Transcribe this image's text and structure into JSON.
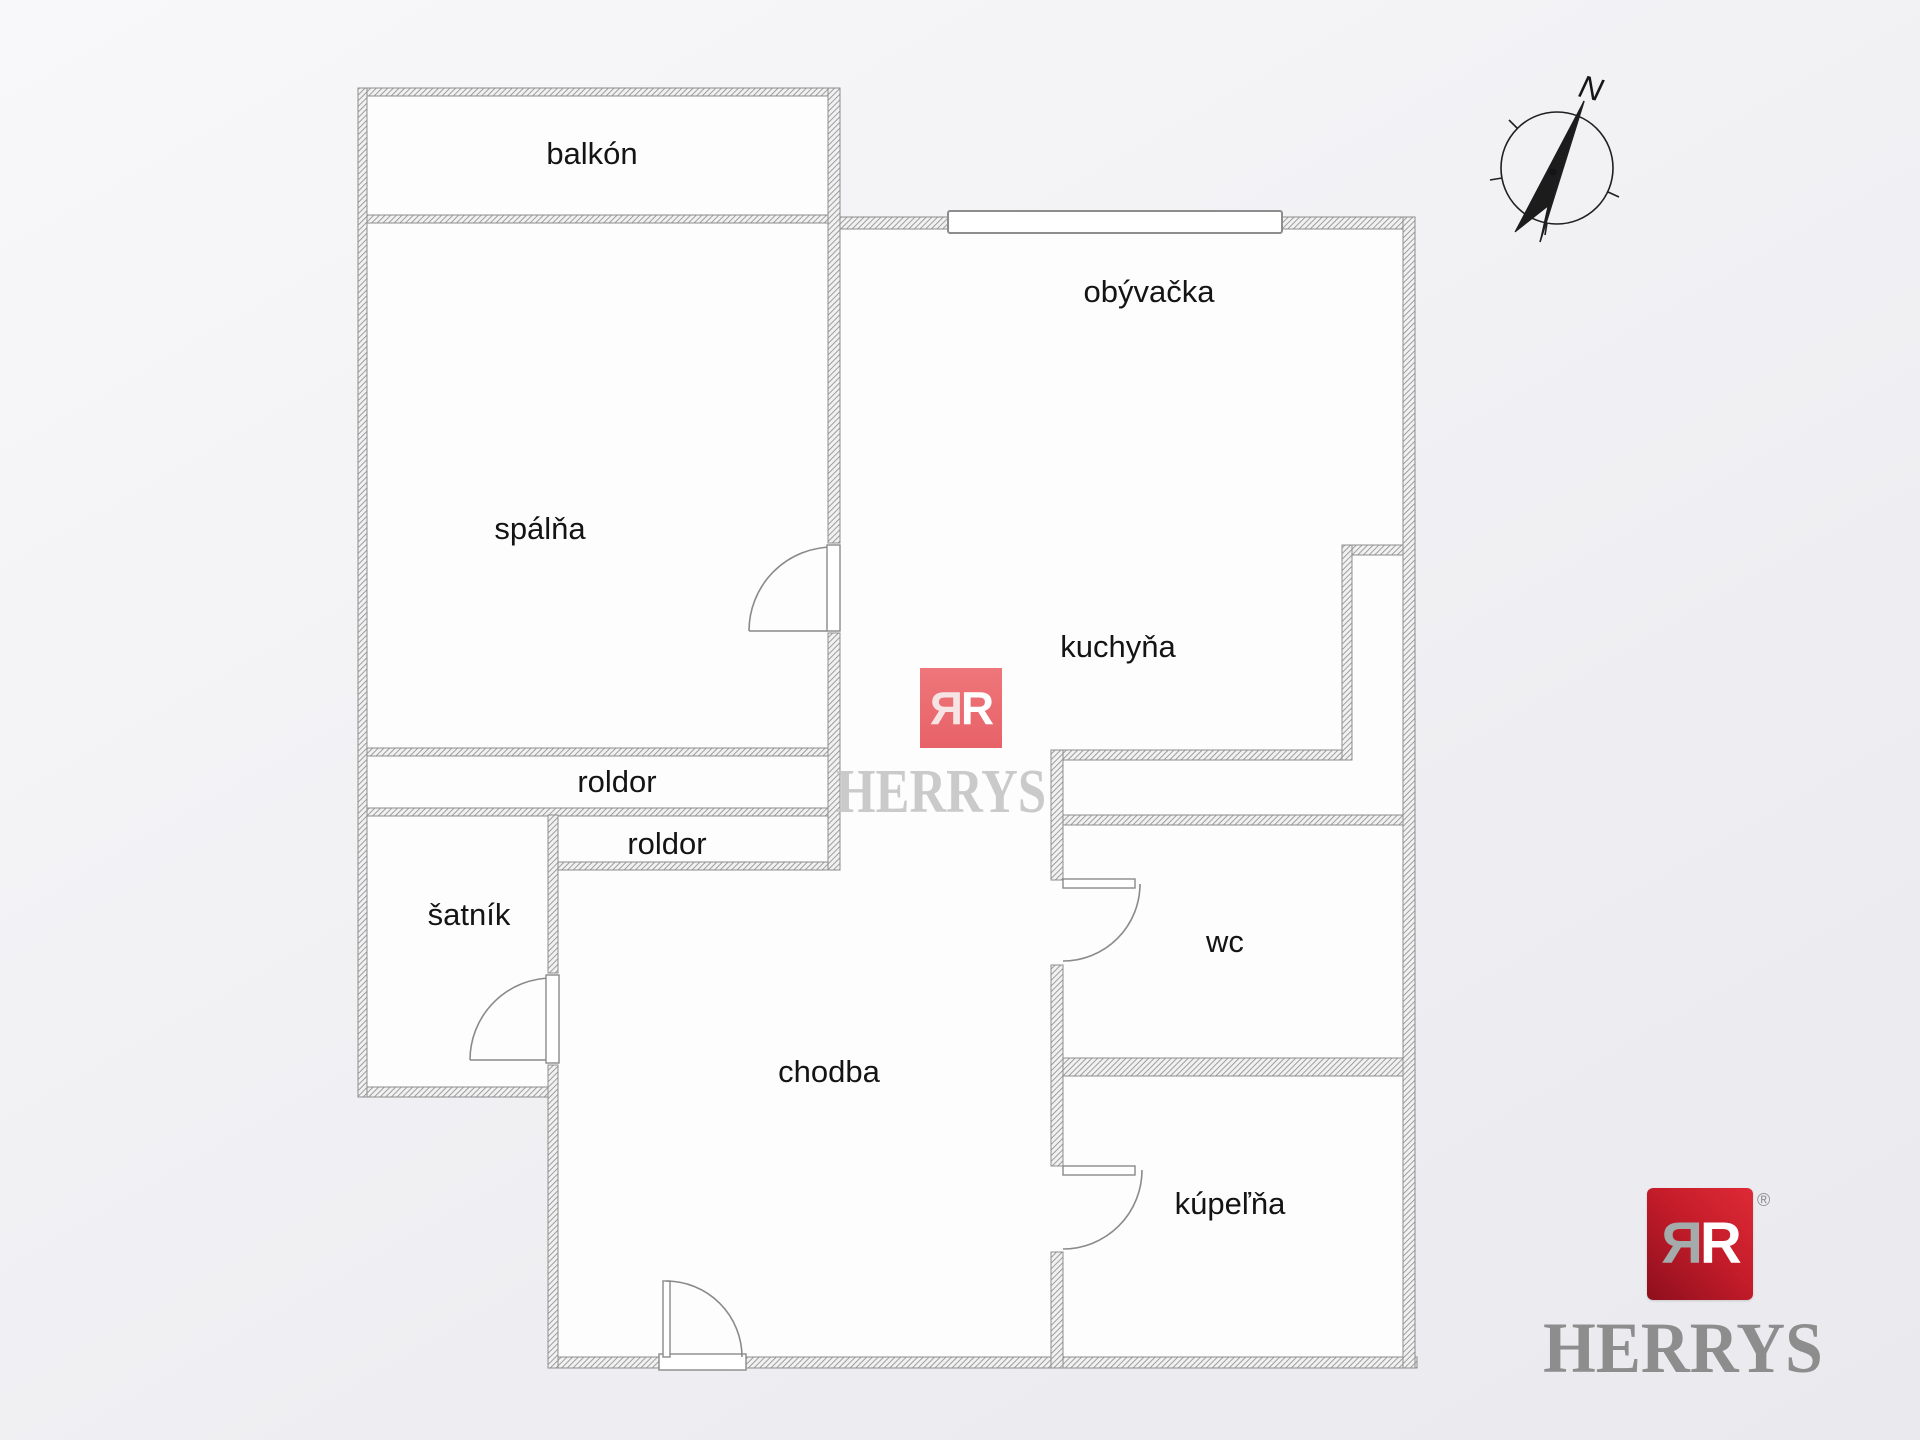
{
  "floorplan": {
    "rooms": [
      {
        "label": "balkón"
      },
      {
        "label": "spálňa"
      },
      {
        "label": "obývačka"
      },
      {
        "label": "kuchyňa"
      },
      {
        "label": "roldor"
      },
      {
        "label": "roldor"
      },
      {
        "label": "šatník"
      },
      {
        "label": "chodba"
      },
      {
        "label": "wc"
      },
      {
        "label": "kúpeľňa"
      }
    ],
    "compass": {
      "north_label": "N"
    }
  },
  "branding": {
    "watermark": {
      "monogram_left": "Я",
      "monogram_right": "R",
      "name": "HERRYS",
      "square_color": "#e9696e",
      "text_color": "#c6c6c6"
    },
    "logo": {
      "monogram_left": "Я",
      "monogram_right": "R",
      "name": "HERRYS",
      "registered_mark": "®",
      "square_color": "#c21b29",
      "text_color": "#8d8d8d"
    }
  }
}
